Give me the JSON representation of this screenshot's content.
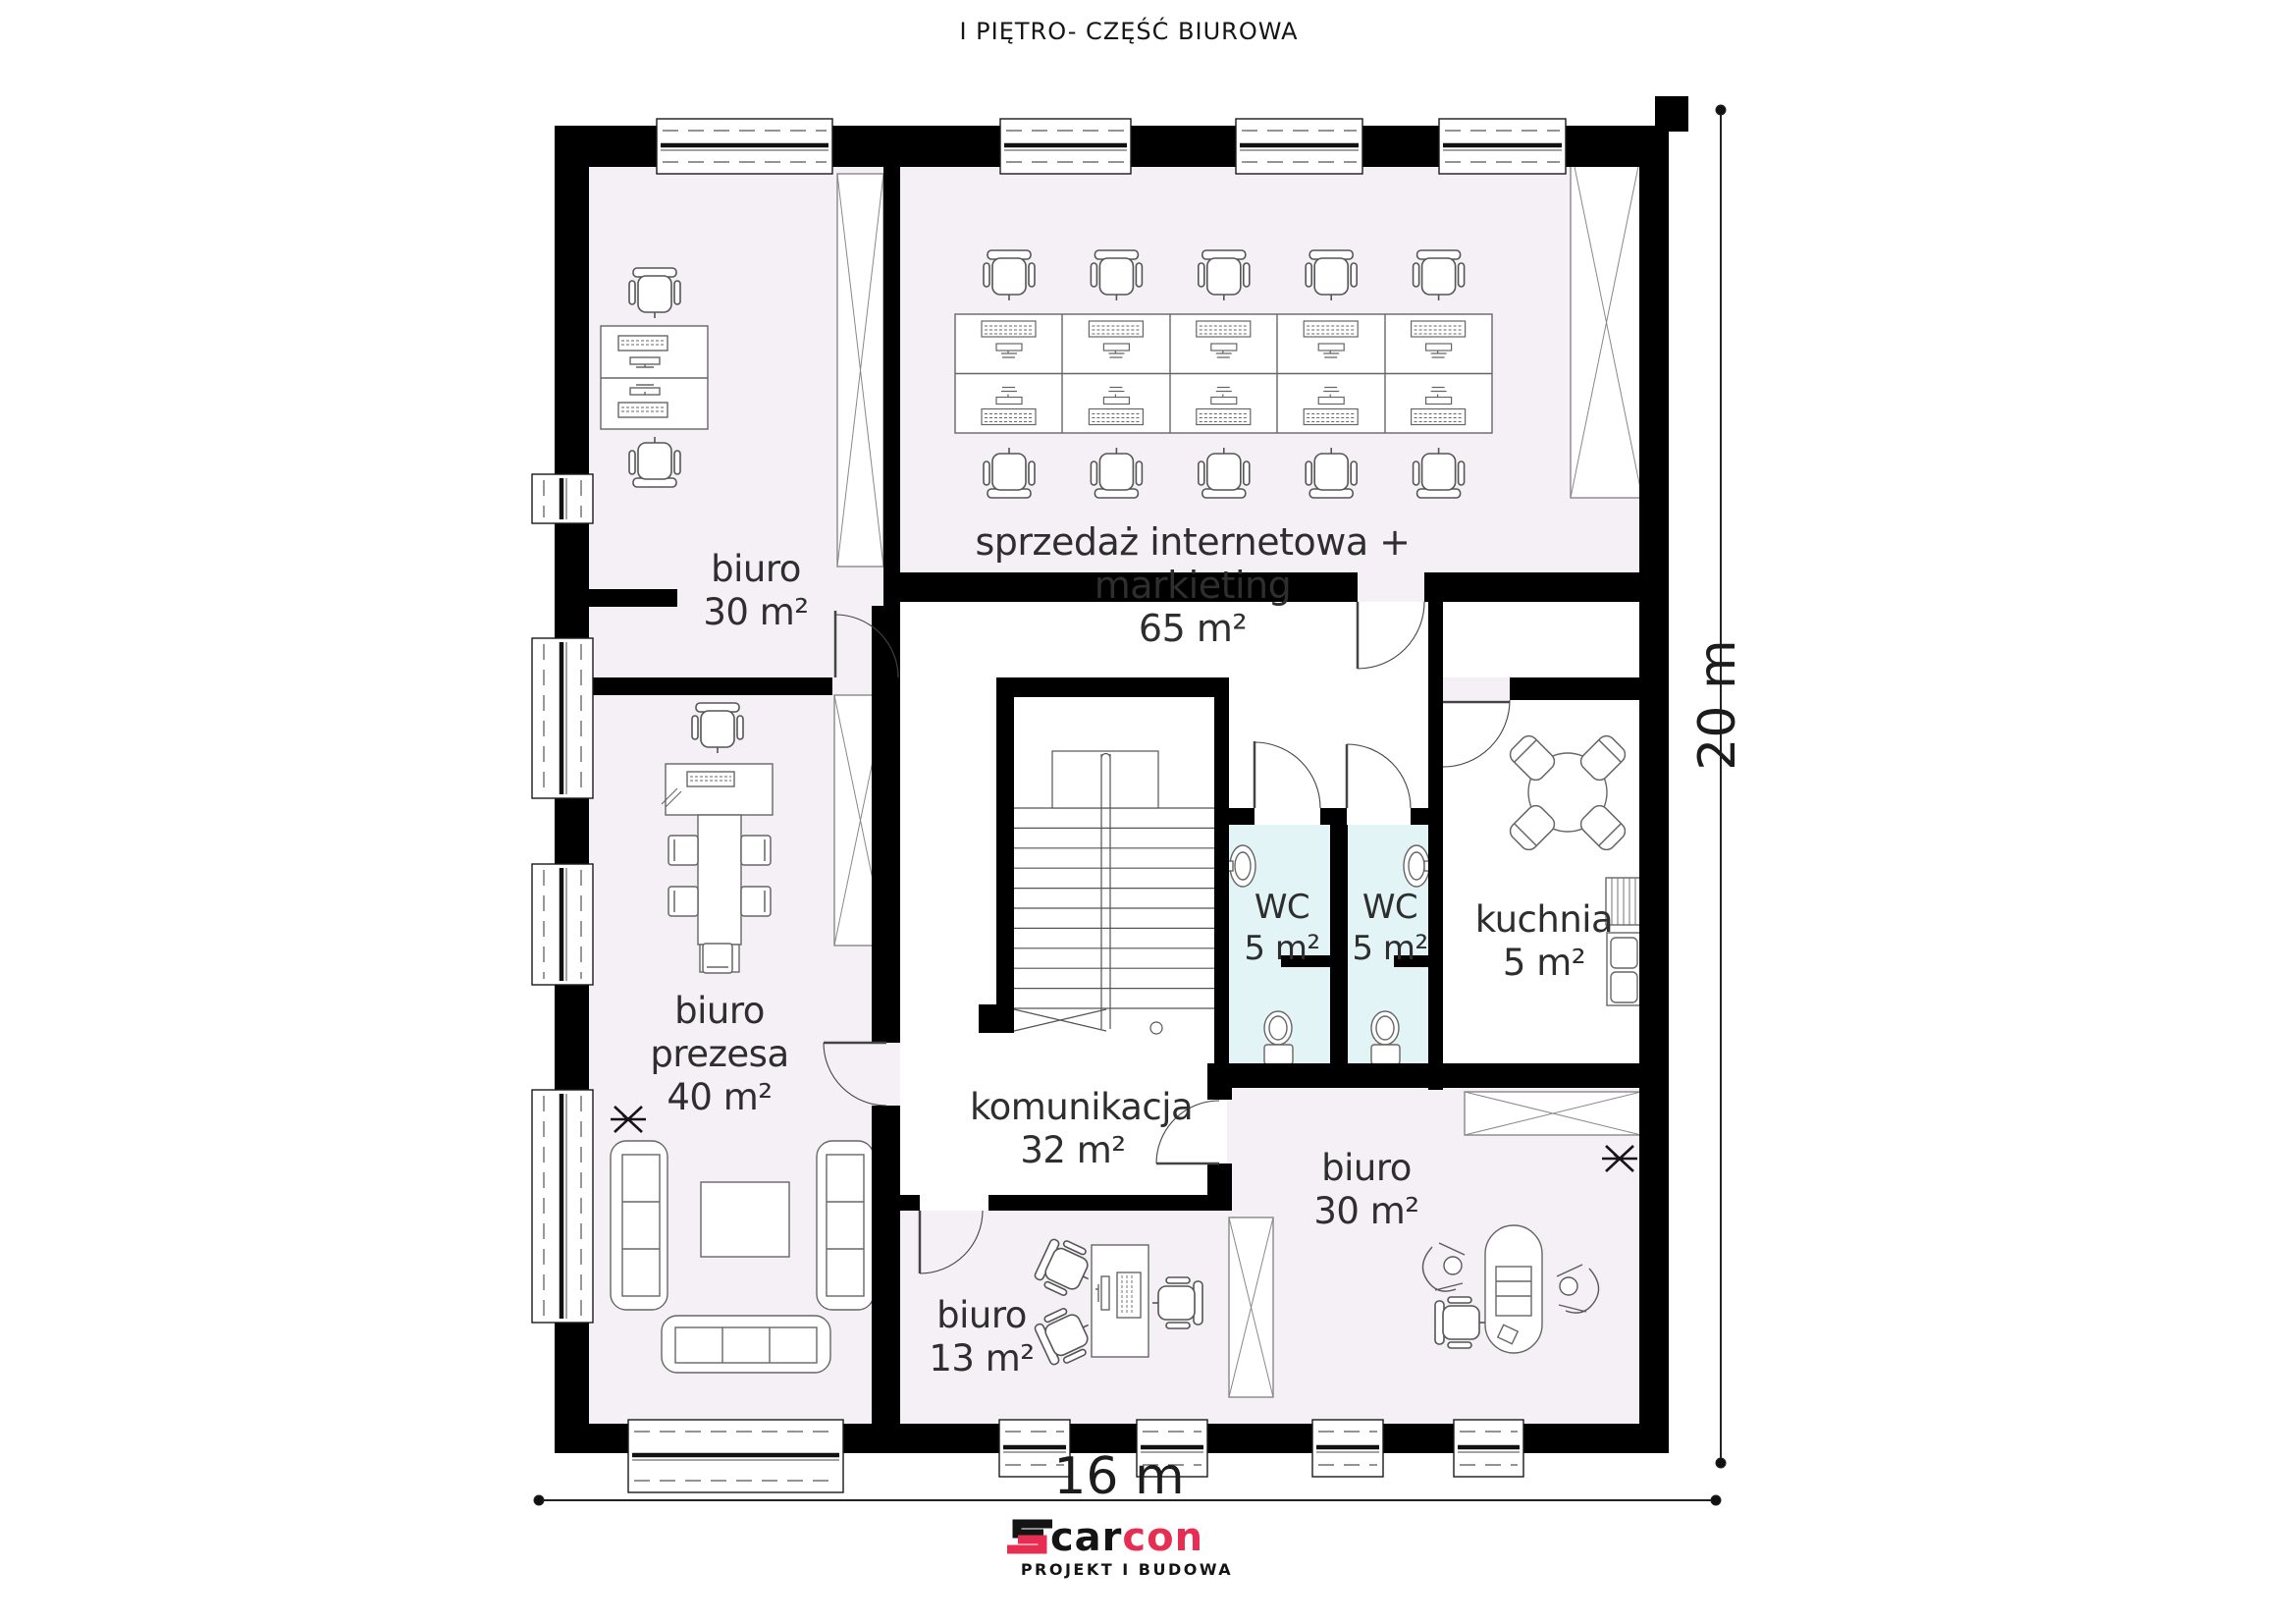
{
  "title": "I PIĘTRO- CZĘŚĆ BIUROWA",
  "rooms": {
    "biuro_tl": {
      "name": "biuro",
      "area": "30 m²"
    },
    "sprzedaz": {
      "name": "sprzedaż internetowa + markieting",
      "area": "65 m²"
    },
    "prezesa": {
      "name": "biuro prezesa",
      "area": "40 m²"
    },
    "komunikacja": {
      "name": "komunikacja",
      "area": "32 m²"
    },
    "wc1": {
      "name": "WC",
      "area": "5 m²"
    },
    "wc2": {
      "name": "WC",
      "area": "5 m²"
    },
    "kuchnia": {
      "name": "kuchnia",
      "area": "5 m²"
    },
    "biuro_br": {
      "name": "biuro",
      "area": "30 m²"
    },
    "biuro_13": {
      "name": "biuro",
      "area": "13 m²"
    }
  },
  "dimensions": {
    "width": "16 m",
    "height": "20 m"
  },
  "logo": {
    "brand_black": "car",
    "brand_red": "con",
    "tagline": "PROJEKT I BUDOWA"
  },
  "colors": {
    "wall": "#000000",
    "room_fill": "#f5f0f5",
    "wc_fill": "#e3f4f6",
    "corridor_fill": "#ffffff",
    "logo_red": "#e62e52",
    "line": "#555555"
  }
}
